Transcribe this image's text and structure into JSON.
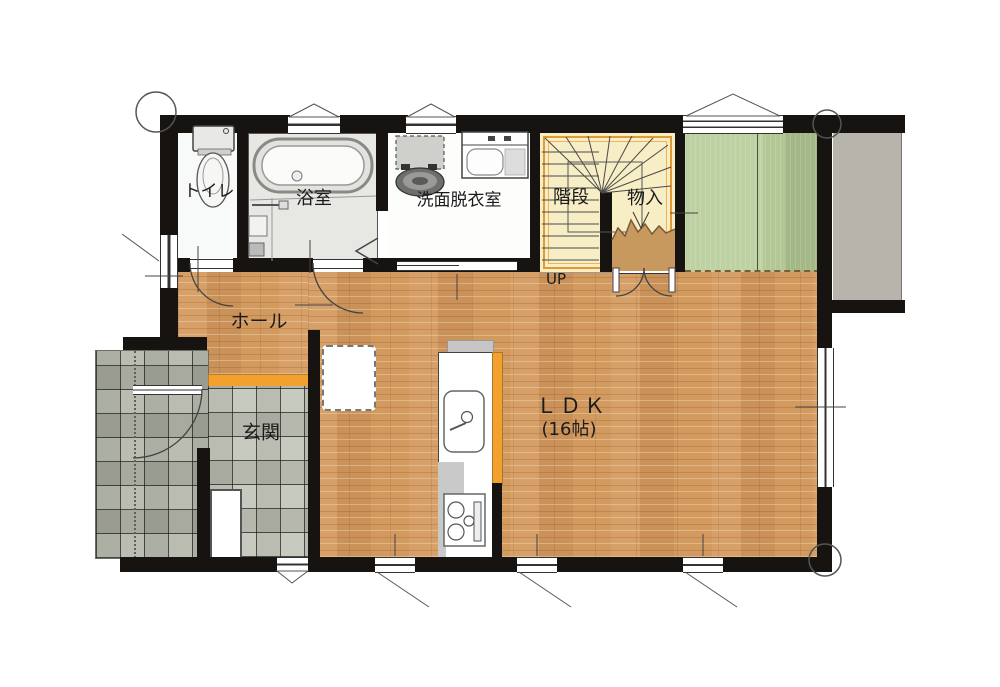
{
  "plan": {
    "type": "floor-plan",
    "floor": "1F",
    "rooms": {
      "toilet": {
        "label": "トイレ"
      },
      "bath": {
        "label": "浴室"
      },
      "washroom": {
        "label": "洗面脱衣室"
      },
      "stairs": {
        "label": "階段",
        "direction": "UP"
      },
      "closet": {
        "label": "物入"
      },
      "hall": {
        "label": "ホール"
      },
      "entrance": {
        "label": "玄関"
      },
      "ldk": {
        "label": "ＬＤＫ",
        "size": "(16帖)"
      }
    },
    "colors": {
      "wall": "#161310",
      "wood_floor": "#d39a5f",
      "entrance_tile": "#bcbfb2",
      "porch_tile": "#afb2a5",
      "stairs_fill": "#f7eec6",
      "stairs_border_orange": "#e29b33",
      "threshold_orange": "#f2a12f",
      "tatami_green": "#bed1a2",
      "terrace_gray": "#b7b5ab",
      "bath_floor": "#e7e7e4",
      "line": "#3a3a3a"
    },
    "fixtures": [
      "toilet-icon",
      "bathtub-icon",
      "shower-faucet-icon",
      "bath-stool-icon",
      "washing-machine-icon",
      "vanity-sink-icon",
      "kitchen-sink-icon",
      "gas-stove-icon",
      "shoe-cabinet-icon",
      "counter-furniture-icon"
    ],
    "symbols": [
      "door-swing-arc",
      "double-door-swing",
      "folding-door",
      "sliding-window",
      "awning-window-triangle",
      "casement-window-line",
      "column-circle",
      "center-tick"
    ]
  }
}
